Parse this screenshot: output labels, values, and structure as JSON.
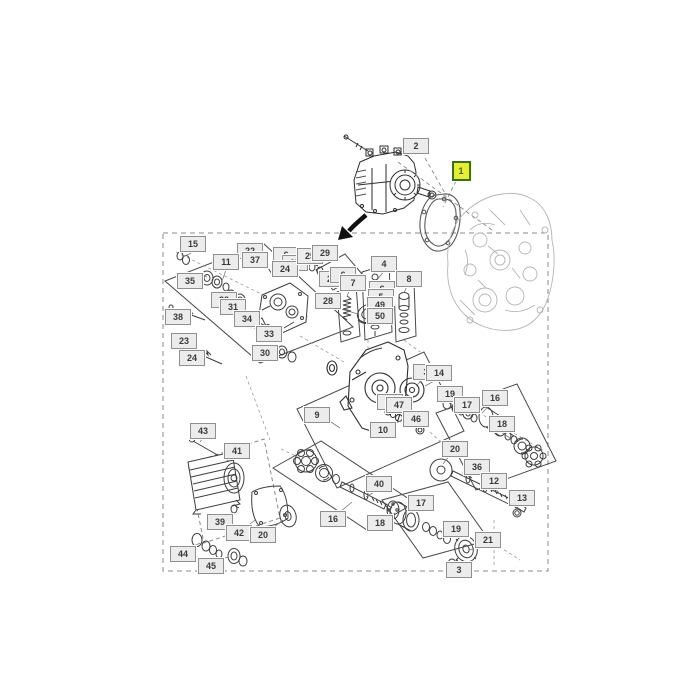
{
  "diagram": {
    "type": "exploded-parts-diagram",
    "description": "Hydrostatic pump and motor exploded parts diagram with numbered callouts",
    "colors": {
      "background": "#ffffff",
      "part_line": "#3f3f3f",
      "faint_line": "#b5b5b5",
      "group_box_line": "#4a4a4a",
      "dashed_line": "#8a8a8a",
      "label_fill": "#ececec",
      "label_border": "#8f8f8f",
      "label_text": "#3a3a3a",
      "highlight_fill": "#e3ee38",
      "highlight_border": "#3c6e1e",
      "arrow": "#111111"
    },
    "callouts": [
      {
        "id": "2",
        "x": 416,
        "y": 146,
        "highlighted": false
      },
      {
        "id": "1",
        "x": 461,
        "y": 171,
        "highlighted": true
      },
      {
        "id": "15",
        "x": 193,
        "y": 244,
        "highlighted": false
      },
      {
        "id": "22",
        "x": 250,
        "y": 251,
        "highlighted": false
      },
      {
        "id": "37",
        "x": 255,
        "y": 260,
        "highlighted": false
      },
      {
        "id": "11",
        "x": 226,
        "y": 262,
        "highlighted": false
      },
      {
        "id": "35",
        "x": 190,
        "y": 281,
        "highlighted": false
      },
      {
        "id": "6",
        "x": 286,
        "y": 255,
        "highlighted": false
      },
      {
        "id": "27",
        "x": 295,
        "y": 263,
        "highlighted": false
      },
      {
        "id": "24",
        "x": 285,
        "y": 269,
        "highlighted": false
      },
      {
        "id": "25",
        "x": 310,
        "y": 256,
        "highlighted": false
      },
      {
        "id": "29",
        "x": 325,
        "y": 253,
        "highlighted": false
      },
      {
        "id": "26",
        "x": 332,
        "y": 279,
        "highlighted": false
      },
      {
        "id": "6",
        "x": 343,
        "y": 275,
        "highlighted": false
      },
      {
        "id": "7",
        "x": 353,
        "y": 283,
        "highlighted": false
      },
      {
        "id": "4",
        "x": 384,
        "y": 264,
        "highlighted": false
      },
      {
        "id": "8",
        "x": 409,
        "y": 279,
        "highlighted": false
      },
      {
        "id": "6",
        "x": 382,
        "y": 289,
        "highlighted": false
      },
      {
        "id": "5",
        "x": 381,
        "y": 297,
        "highlighted": false
      },
      {
        "id": "49",
        "x": 380,
        "y": 305,
        "highlighted": false
      },
      {
        "id": "50",
        "x": 380,
        "y": 316,
        "highlighted": false
      },
      {
        "id": "32",
        "x": 224,
        "y": 300,
        "highlighted": false
      },
      {
        "id": "31",
        "x": 233,
        "y": 307,
        "highlighted": false
      },
      {
        "id": "38",
        "x": 178,
        "y": 317,
        "highlighted": false
      },
      {
        "id": "34",
        "x": 247,
        "y": 319,
        "highlighted": false
      },
      {
        "id": "33",
        "x": 269,
        "y": 334,
        "highlighted": false
      },
      {
        "id": "28",
        "x": 328,
        "y": 301,
        "highlighted": false
      },
      {
        "id": "23",
        "x": 184,
        "y": 341,
        "highlighted": false
      },
      {
        "id": "24",
        "x": 192,
        "y": 358,
        "highlighted": false
      },
      {
        "id": "30",
        "x": 265,
        "y": 353,
        "highlighted": false
      },
      {
        "id": "9",
        "x": 317,
        "y": 415,
        "highlighted": false
      },
      {
        "id": "3",
        "x": 426,
        "y": 372,
        "highlighted": false
      },
      {
        "id": "14",
        "x": 439,
        "y": 373,
        "highlighted": false
      },
      {
        "id": "48",
        "x": 390,
        "y": 402,
        "highlighted": false
      },
      {
        "id": "47",
        "x": 399,
        "y": 405,
        "highlighted": false
      },
      {
        "id": "46",
        "x": 416,
        "y": 419,
        "highlighted": false
      },
      {
        "id": "10",
        "x": 383,
        "y": 430,
        "highlighted": false
      },
      {
        "id": "19",
        "x": 450,
        "y": 394,
        "highlighted": false
      },
      {
        "id": "17",
        "x": 467,
        "y": 405,
        "highlighted": false
      },
      {
        "id": "16",
        "x": 495,
        "y": 398,
        "highlighted": false
      },
      {
        "id": "18",
        "x": 502,
        "y": 424,
        "highlighted": false
      },
      {
        "id": "20",
        "x": 455,
        "y": 449,
        "highlighted": false
      },
      {
        "id": "36",
        "x": 477,
        "y": 467,
        "highlighted": false
      },
      {
        "id": "12",
        "x": 494,
        "y": 481,
        "highlighted": false
      },
      {
        "id": "13",
        "x": 522,
        "y": 498,
        "highlighted": false
      },
      {
        "id": "43",
        "x": 203,
        "y": 431,
        "highlighted": false
      },
      {
        "id": "41",
        "x": 237,
        "y": 451,
        "highlighted": false
      },
      {
        "id": "39",
        "x": 220,
        "y": 522,
        "highlighted": false
      },
      {
        "id": "42",
        "x": 239,
        "y": 533,
        "highlighted": false
      },
      {
        "id": "20",
        "x": 263,
        "y": 535,
        "highlighted": false
      },
      {
        "id": "44",
        "x": 183,
        "y": 554,
        "highlighted": false
      },
      {
        "id": "45",
        "x": 211,
        "y": 566,
        "highlighted": false
      },
      {
        "id": "16",
        "x": 333,
        "y": 519,
        "highlighted": false
      },
      {
        "id": "40",
        "x": 379,
        "y": 484,
        "highlighted": false
      },
      {
        "id": "18",
        "x": 380,
        "y": 523,
        "highlighted": false
      },
      {
        "id": "17",
        "x": 421,
        "y": 503,
        "highlighted": false
      },
      {
        "id": "19",
        "x": 456,
        "y": 529,
        "highlighted": false
      },
      {
        "id": "21",
        "x": 488,
        "y": 540,
        "highlighted": false
      },
      {
        "id": "3",
        "x": 459,
        "y": 570,
        "highlighted": false
      }
    ]
  }
}
